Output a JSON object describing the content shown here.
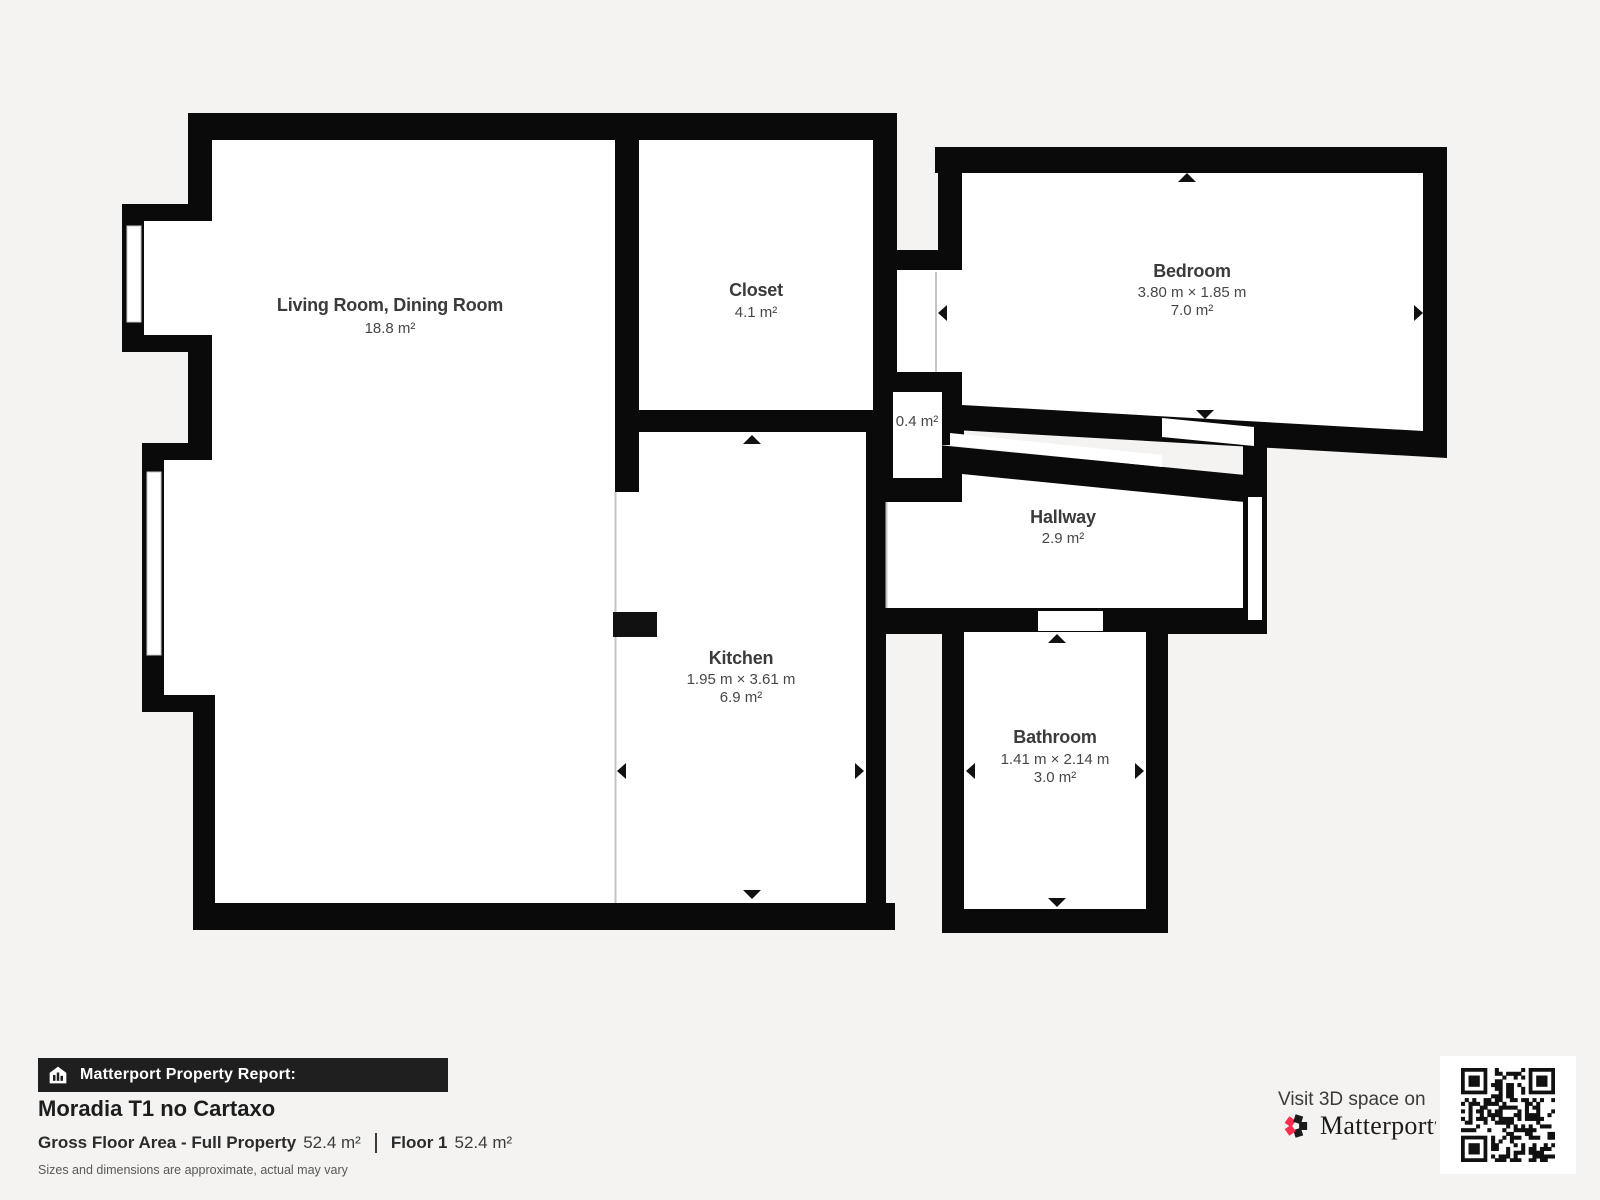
{
  "plan": {
    "rooms": {
      "living": {
        "name": "Living Room, Dining Room",
        "area": "18.8 m²"
      },
      "closet": {
        "name": "Closet",
        "area": "4.1 m²"
      },
      "bedroom": {
        "name": "Bedroom",
        "dims": "3.80 m × 1.85 m",
        "area": "7.0 m²"
      },
      "vestibule": {
        "area": "0.4 m²"
      },
      "hallway": {
        "name": "Hallway",
        "area": "2.9 m²"
      },
      "kitchen": {
        "name": "Kitchen",
        "dims": "1.95 m × 3.61 m",
        "area": "6.9 m²"
      },
      "bathroom": {
        "name": "Bathroom",
        "dims": "1.41 m × 2.14 m",
        "area": "3.0 m²"
      }
    }
  },
  "footer": {
    "report_label": "Matterport Property Report:",
    "property_name": "Moradia T1 no Cartaxo",
    "gross_label": "Gross Floor Area - Full Property",
    "gross_value": "52.4 m²",
    "floor_label": "Floor 1",
    "floor_value": "52.4 m²",
    "disclaimer": "Sizes and dimensions are approximate, actual may vary"
  },
  "cta": {
    "visit_text": "Visit 3D space on",
    "brand": "Matterport",
    "trademark": "′"
  },
  "colors": {
    "wall": "#0a0a0a",
    "background": "#f4f3f1",
    "room": "#ffffff",
    "open_boundary": "#c4c4c4",
    "brand_red": "#fb2e4e",
    "bar_black": "#1f1f1f"
  }
}
